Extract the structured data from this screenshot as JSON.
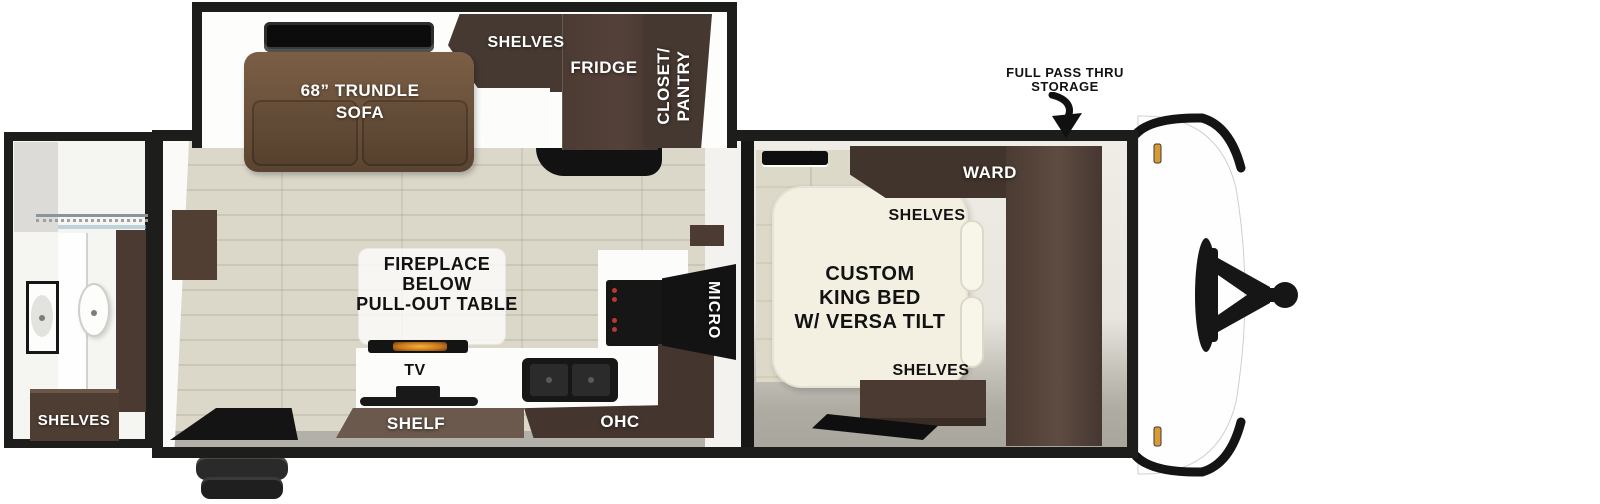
{
  "labels": {
    "shower": "SHOWER",
    "bath_shelves": "SHELVES",
    "sofa_line1": "68” TRUNDLE",
    "sofa_line2": "SOFA",
    "shelves_top": "SHELVES",
    "fridge": "FRIDGE",
    "closet_line1": "CLOSET/",
    "closet_line2": "PANTRY",
    "fireplace_line1": "FIREPLACE",
    "fireplace_line2": "BELOW",
    "fireplace_line3": "PULL-OUT TABLE",
    "tv": "TV",
    "shelf": "SHELF",
    "ohc": "OHC",
    "micro": "MICRO",
    "ward": "WARD",
    "bed_shelves_top": "SHELVES",
    "bed_line1": "CUSTOM",
    "bed_line2": "KING BED",
    "bed_line3": "W/ VERSA TILT",
    "bed_shelves_bottom": "SHELVES",
    "storage_line1": "FULL PASS THRU",
    "storage_line2": "STORAGE"
  },
  "colors": {
    "outline_black": "#1d1d1b",
    "dark_wood": "#46362e",
    "mid_wood": "#6a594c",
    "sofa_brown": "#6e5540",
    "floor_wood": "#d9d5c7",
    "floor_gray": "#aeaba3",
    "bed_cream": "#f3f0e2",
    "clearance_light_orange": "#d99a33",
    "flame_orange": "#f6b23c"
  }
}
